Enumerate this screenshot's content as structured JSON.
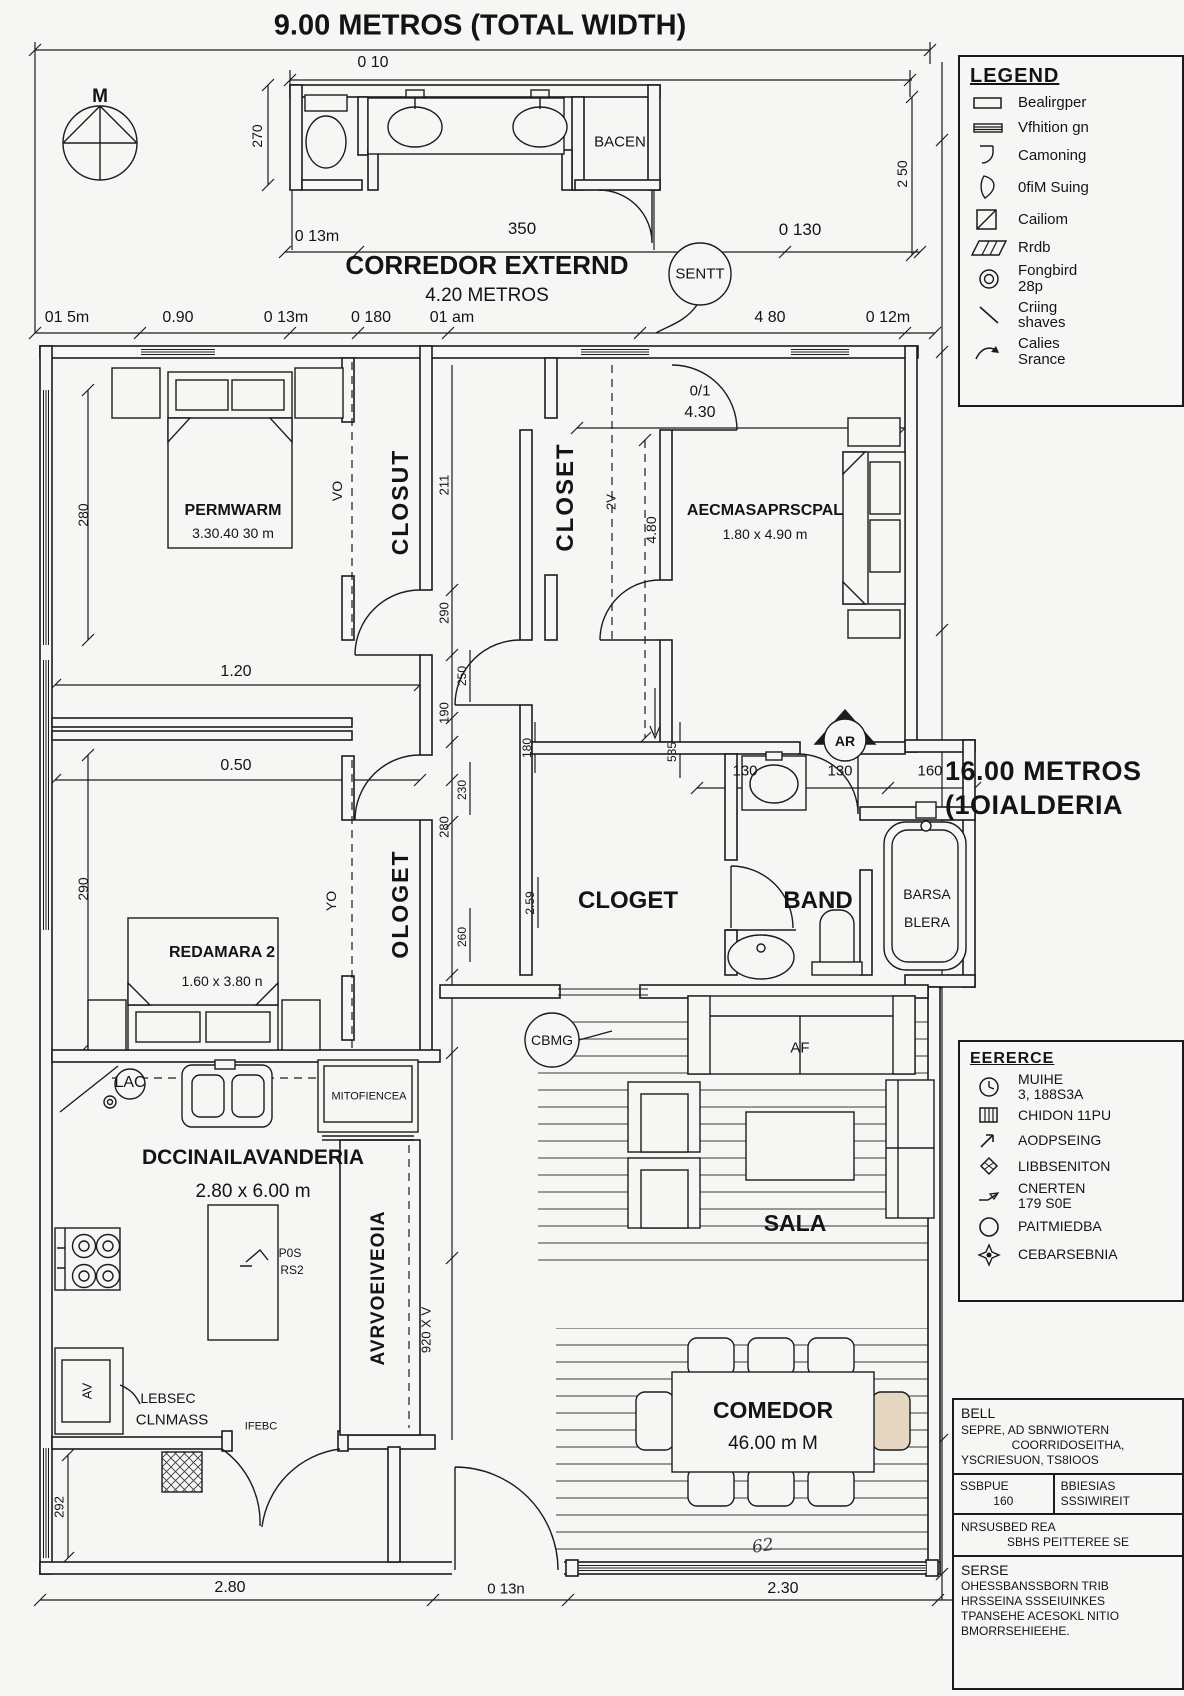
{
  "title": "9.00 METROS (TOTAL WIDTH)",
  "compass_label": "M",
  "annex": {
    "bacen": "BACEN"
  },
  "corridor": {
    "name": "CORREDOR EXTERND",
    "size": "4.20 METROS",
    "sentt": "SENTT"
  },
  "dims": {
    "top_width": "0 10",
    "annex_left_v": "270",
    "annex_right_v": "2 50",
    "row2_left": "0 13m",
    "row2_mid": "350",
    "row2_right": "0 130",
    "row3_1": "01 5m",
    "row3_2": "0.90",
    "row3_3": "0 13m",
    "row3_4": "0 180",
    "row3_5": "01 am",
    "row3_6": "4 80",
    "row3_7": "0 12m",
    "master_top_a": "0/1",
    "master_top_b": "4.30",
    "master_v": "4.80",
    "hall_1": "1.20",
    "hall_2": "0.50",
    "left_v1": "280",
    "left_v2": "290",
    "left_v3": "292",
    "chain_1": "211",
    "chain_2": "290",
    "chain_3": "190",
    "chain_4": "280",
    "chain_5": "250",
    "chain_6": "230",
    "chain_7": "260",
    "chain_8": "180",
    "chain_9": "2.59",
    "chain_10": "535",
    "band_1": "130",
    "band_2": "130",
    "band_3": "160",
    "bottom_1": "2.80",
    "bottom_2": "0 13n",
    "bottom_3": "2.30",
    "note": "62"
  },
  "rooms": {
    "bedroom1": {
      "name": "PERMWARM",
      "size": "3.30.40 30 m"
    },
    "closet1": {
      "name": "CLOSUT",
      "tag": "VO"
    },
    "closet_master": {
      "name": "CLOSET",
      "tag": "2V"
    },
    "master": {
      "name": "AECMASAPRSCPAL",
      "size": "1.80 x 4.90 m"
    },
    "bedroom2": {
      "name": "REDAMARA 2",
      "size": "1.60 x 3.80 n"
    },
    "closet2": {
      "name": "OLOGET",
      "tag": "YO"
    },
    "cloget": "CLOGET",
    "band": "BAND",
    "bath": {
      "line1": "BARSA",
      "line2": "BLERA"
    },
    "ar_badge": "AR",
    "kitchen": {
      "name": "DCCINAILAVANDERIA",
      "size": "2.80 x 6.00 m",
      "lac": "LAC",
      "fridge": "MITOFIENCEA",
      "note1": "P0S",
      "note2": "RS2",
      "av": "AV",
      "pantry1": "LEBSEC",
      "pantry2": "CLNMASS",
      "door": "IFEBC",
      "column_label": "AVRVOEIVEOIA",
      "column_tag": "920 X V"
    },
    "sala": {
      "name": "SALA",
      "sofa": "AF",
      "cbmg": "CBMG"
    },
    "comedor": {
      "name": "COMEDOR",
      "size": "46.00 m M"
    }
  },
  "side": {
    "total_line1": "16.00 METROS",
    "total_line2": "(1OIALDERIA"
  },
  "legend": {
    "title": "LEGEND",
    "items": [
      {
        "icon": "rect-icon",
        "label": "Bealirgper"
      },
      {
        "icon": "double-lines-icon",
        "label": "Vfhition gn"
      },
      {
        "icon": "door-frame-icon",
        "label": "Camoning"
      },
      {
        "icon": "door-swing-icon",
        "label": "0fiM Suing"
      },
      {
        "icon": "square-diagonal-icon",
        "label": "Cailiom"
      },
      {
        "icon": "hatch-icon",
        "label": "Rrdb"
      },
      {
        "icon": "double-circle-icon",
        "label": "Fongbird\n28p"
      },
      {
        "icon": "diagonal-line-icon",
        "label": "Criing\nshaves"
      },
      {
        "icon": "curved-arrow-icon",
        "label": "Calies\nSrance"
      }
    ]
  },
  "reference": {
    "title": "EERERCE",
    "items": [
      {
        "icon": "clock-icon",
        "label": "MUIHE\n3, 188S3A"
      },
      {
        "icon": "grid-icon",
        "label": "CHIDON 11PU"
      },
      {
        "icon": "bent-arrow-icon",
        "label": "AODPSEING"
      },
      {
        "icon": "diamond-icon",
        "label": "LIBBSENITON"
      },
      {
        "icon": "arrow-icon",
        "label": "CNERTEN\n179 S0E"
      },
      {
        "icon": "circle-icon",
        "label": "PAITMIEDBA"
      },
      {
        "icon": "star-icon",
        "label": "CEBARSEBNIA"
      }
    ]
  },
  "info": {
    "title": "BELL",
    "line1": "SEPRE, AD SBNWIOTERN",
    "line2": "COORRIDOSEITHA,",
    "line3": "YSCRIESUON, TS8IOOS",
    "cell1a": "SSBPUE",
    "cell1b": "160",
    "cell2a": "BBIESIAS",
    "cell2b": "SSSIWIREIT",
    "sec2_title": "NRSUSBED REA",
    "sec2_line": "SBHS PEITTEREE SE",
    "sec3_title": "SERSE",
    "sec3_line1": "OHESSBANSSBORN TRIB",
    "sec3_line2": "HRSSEINA SSSEIUINKES",
    "sec3_line3": "TPANSEHE ACESOKL NITIO",
    "sec3_line4": "BMORRSEHIEEHE."
  }
}
